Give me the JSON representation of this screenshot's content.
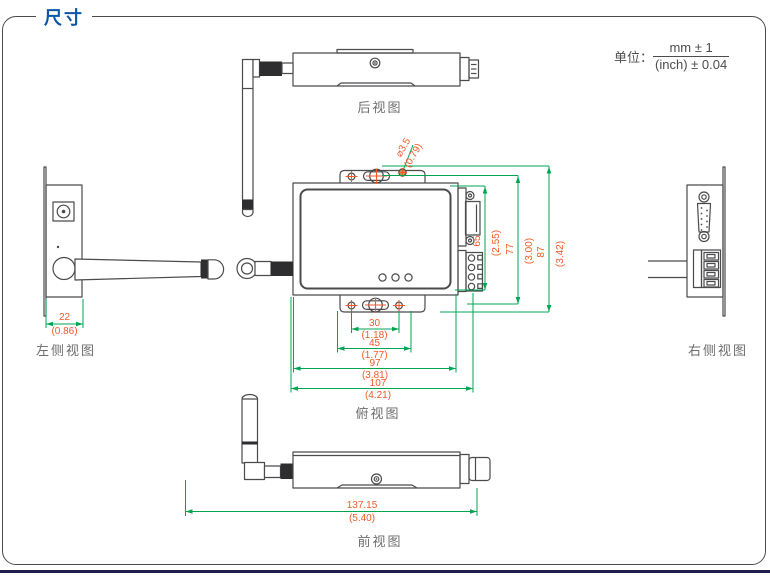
{
  "header": {
    "title": "尺寸"
  },
  "unit": {
    "label": "单位：",
    "mm": "mm ± 1",
    "inch": "(inch) ± 0.04"
  },
  "views": {
    "rear": "后视图",
    "left": "左侧视图",
    "right": "右侧视图",
    "top": "俯视图",
    "front": "前视图"
  },
  "dims": {
    "hole": {
      "mm": "⌀3.5",
      "inch": "(0.79)"
    },
    "d22": {
      "mm": "22",
      "inch": "(0.86)"
    },
    "d30": {
      "mm": "30",
      "inch": "(1.18)"
    },
    "d45": {
      "mm": "45",
      "inch": "(1.77)"
    },
    "d97": {
      "mm": "97",
      "inch": "(3.81)"
    },
    "d107": {
      "mm": "107",
      "inch": "(4.21)"
    },
    "d137": {
      "mm": "137.15",
      "inch": "(5.40)"
    },
    "d65": {
      "mm": "65",
      "inch": "(2.55)"
    },
    "d77": {
      "mm": "77",
      "inch": "(3.00)"
    },
    "d87": {
      "mm": "87",
      "inch": "(3.42)"
    }
  },
  "colors": {
    "accent_blue": "#0b56a6",
    "dim_green": "#00a554",
    "dim_orange": "#f05a28"
  }
}
